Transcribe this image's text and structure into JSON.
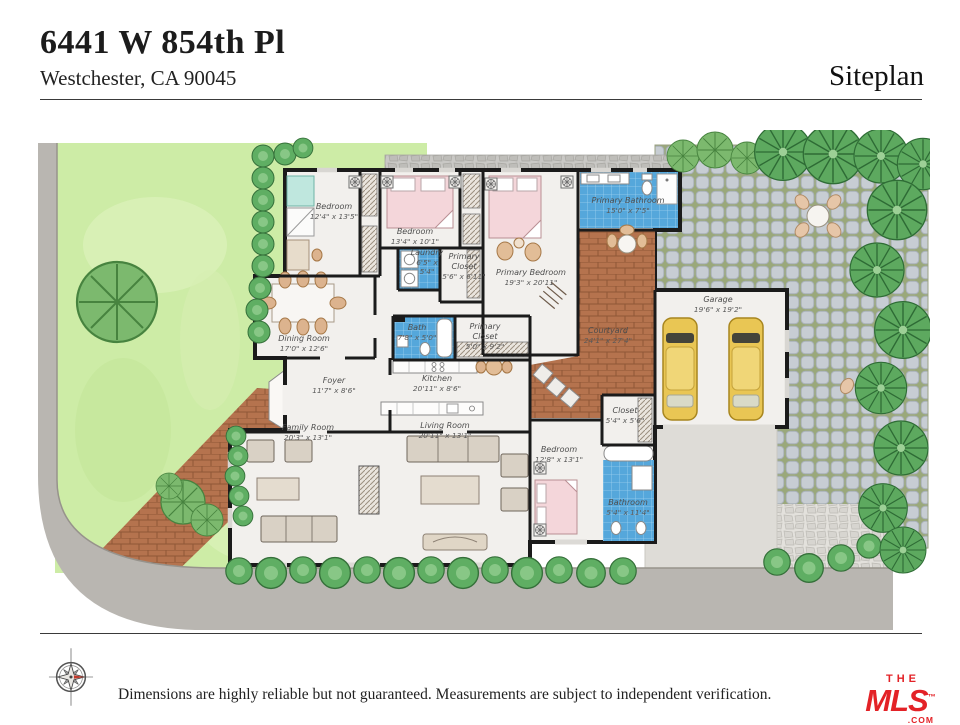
{
  "header": {
    "address_line1": "6441 W 854th Pl",
    "address_line2": "Westchester, CA 90045",
    "plan_label": "Siteplan"
  },
  "floorplan": {
    "rooms": [
      {
        "name": "Bedroom",
        "dims": "12'4\" x 13'5\""
      },
      {
        "name": "Bedroom",
        "dims": "13'4\" x 10'1\""
      },
      {
        "name": "Primary Bathroom",
        "dims": "15'0\" x 7'5\""
      },
      {
        "name": "Laundry",
        "dims": "6'5\" x 5'4\""
      },
      {
        "name": "Primary Closet",
        "dims": "5'6\" x 6'11\""
      },
      {
        "name": "Primary Bedroom",
        "dims": "19'3\" x 20'11\""
      },
      {
        "name": "Dining Room",
        "dims": "17'0\" x 12'6\""
      },
      {
        "name": "Bath",
        "dims": "7'8\" x 5'0\""
      },
      {
        "name": "Primary Closet",
        "dims": "5'0\" x 9'2\""
      },
      {
        "name": "Courtyard",
        "dims": "24'1\" x 27'4\""
      },
      {
        "name": "Garage",
        "dims": "19'6\" x 19'2\""
      },
      {
        "name": "Foyer",
        "dims": "11'7\" x 8'6\""
      },
      {
        "name": "Kitchen",
        "dims": "20'11\" x 8'6\""
      },
      {
        "name": "Closet",
        "dims": "5'4\" x 5'6\""
      },
      {
        "name": "Family Room",
        "dims": "20'3\" x 13'1\""
      },
      {
        "name": "Living Room",
        "dims": "20'11\" x 13'1\""
      },
      {
        "name": "Bedroom",
        "dims": "12'8\" x 13'1\""
      },
      {
        "name": "Bathroom",
        "dims": "5'4\" x 11'4\""
      }
    ]
  },
  "site": {
    "features": [
      "street-sidewalk",
      "front-lawn",
      "hedge-row",
      "brick-walkway",
      "flagstone-path",
      "cobblestone-patio",
      "patio-table-and-chairs",
      "courtyard-table",
      "planter-boxes",
      "driveway",
      "palm-trees",
      "shrubs",
      "two-cars-in-garage",
      "fireplace",
      "compass-rose"
    ]
  },
  "footer": {
    "disclaimer": "Dimensions are highly reliable but not guaranteed. Measurements are subject to independent verification.",
    "brand": {
      "top": "THE",
      "main": "MLS",
      "suffix": ".COM",
      "trademark": "™"
    }
  },
  "colors": {
    "logo_red": "#e32227",
    "tile_blue": "#55a7db",
    "brick_terracotta": "#b5734e",
    "lawn_green": "#cdeca6",
    "tree_green": "#5da95f",
    "street_gray": "#b9b6b1"
  }
}
